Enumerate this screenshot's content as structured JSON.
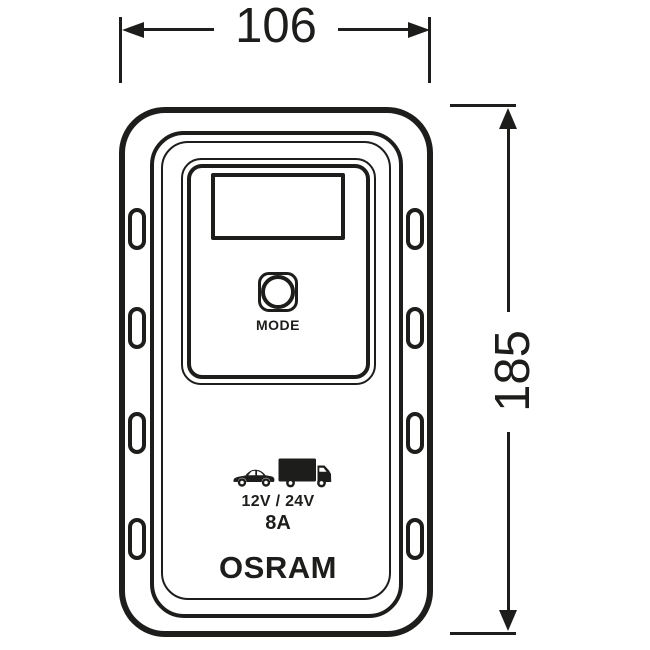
{
  "colors": {
    "line": "#1d1d1b",
    "background": "#ffffff"
  },
  "dimensions": {
    "width_label": "106",
    "height_label": "185"
  },
  "device": {
    "mode_button_label": "MODE",
    "voltage_rating": "12V / 24V",
    "current_rating": "8A",
    "brand": "OSRAM",
    "vehicle_icons": [
      "car-icon",
      "truck-icon"
    ]
  }
}
